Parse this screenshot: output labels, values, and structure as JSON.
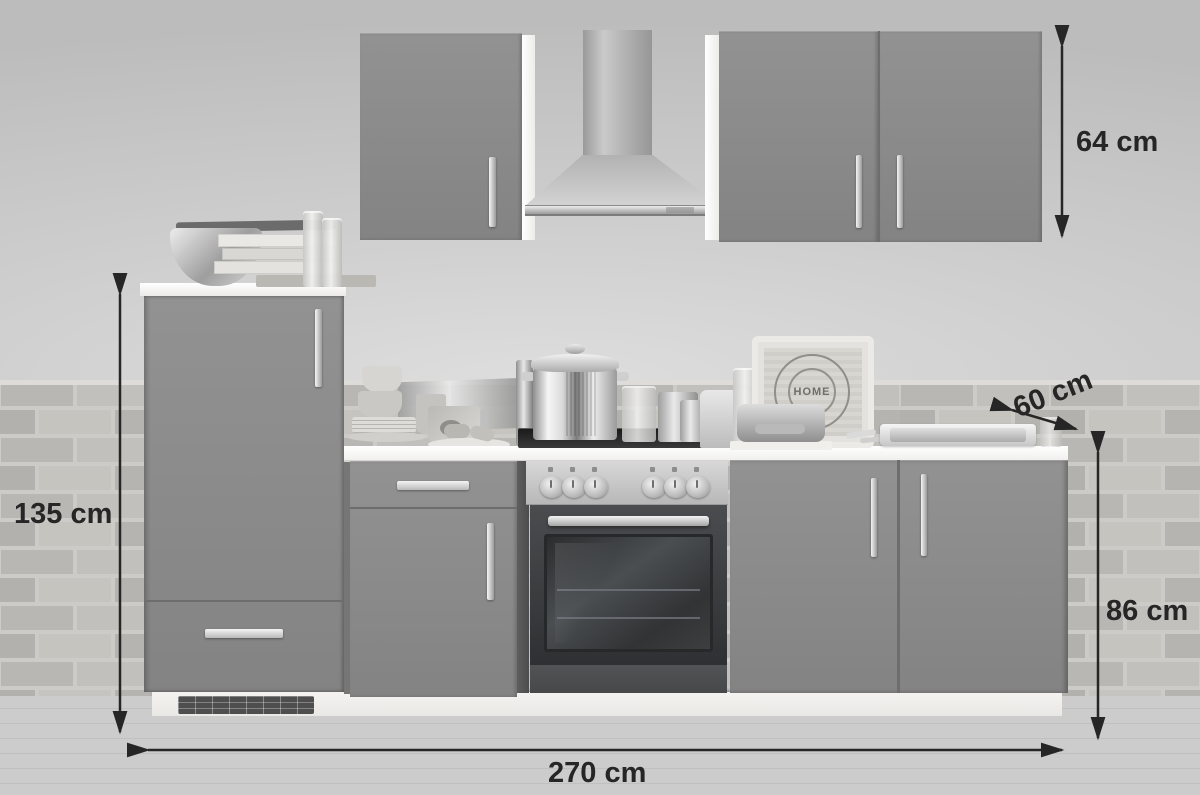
{
  "dimensions": {
    "wall_cabinets_height": "64 cm",
    "worktop_depth": "60 cm",
    "tall_unit_height": "135 cm",
    "base_units_height": "86 cm",
    "total_width": "270 cm"
  },
  "decor": {
    "tray_stamp_text": "HOME"
  },
  "colors": {
    "cabinet_front": "#8c8c8c",
    "cabinet_side_white": "#f3f3f1",
    "worktop_white": "#f7f6f4",
    "brick_wall": "#bdbbb7",
    "annotation_text": "#262626",
    "oven_door_dark": "#35373a",
    "stainless_light": "#d9d9d9"
  }
}
